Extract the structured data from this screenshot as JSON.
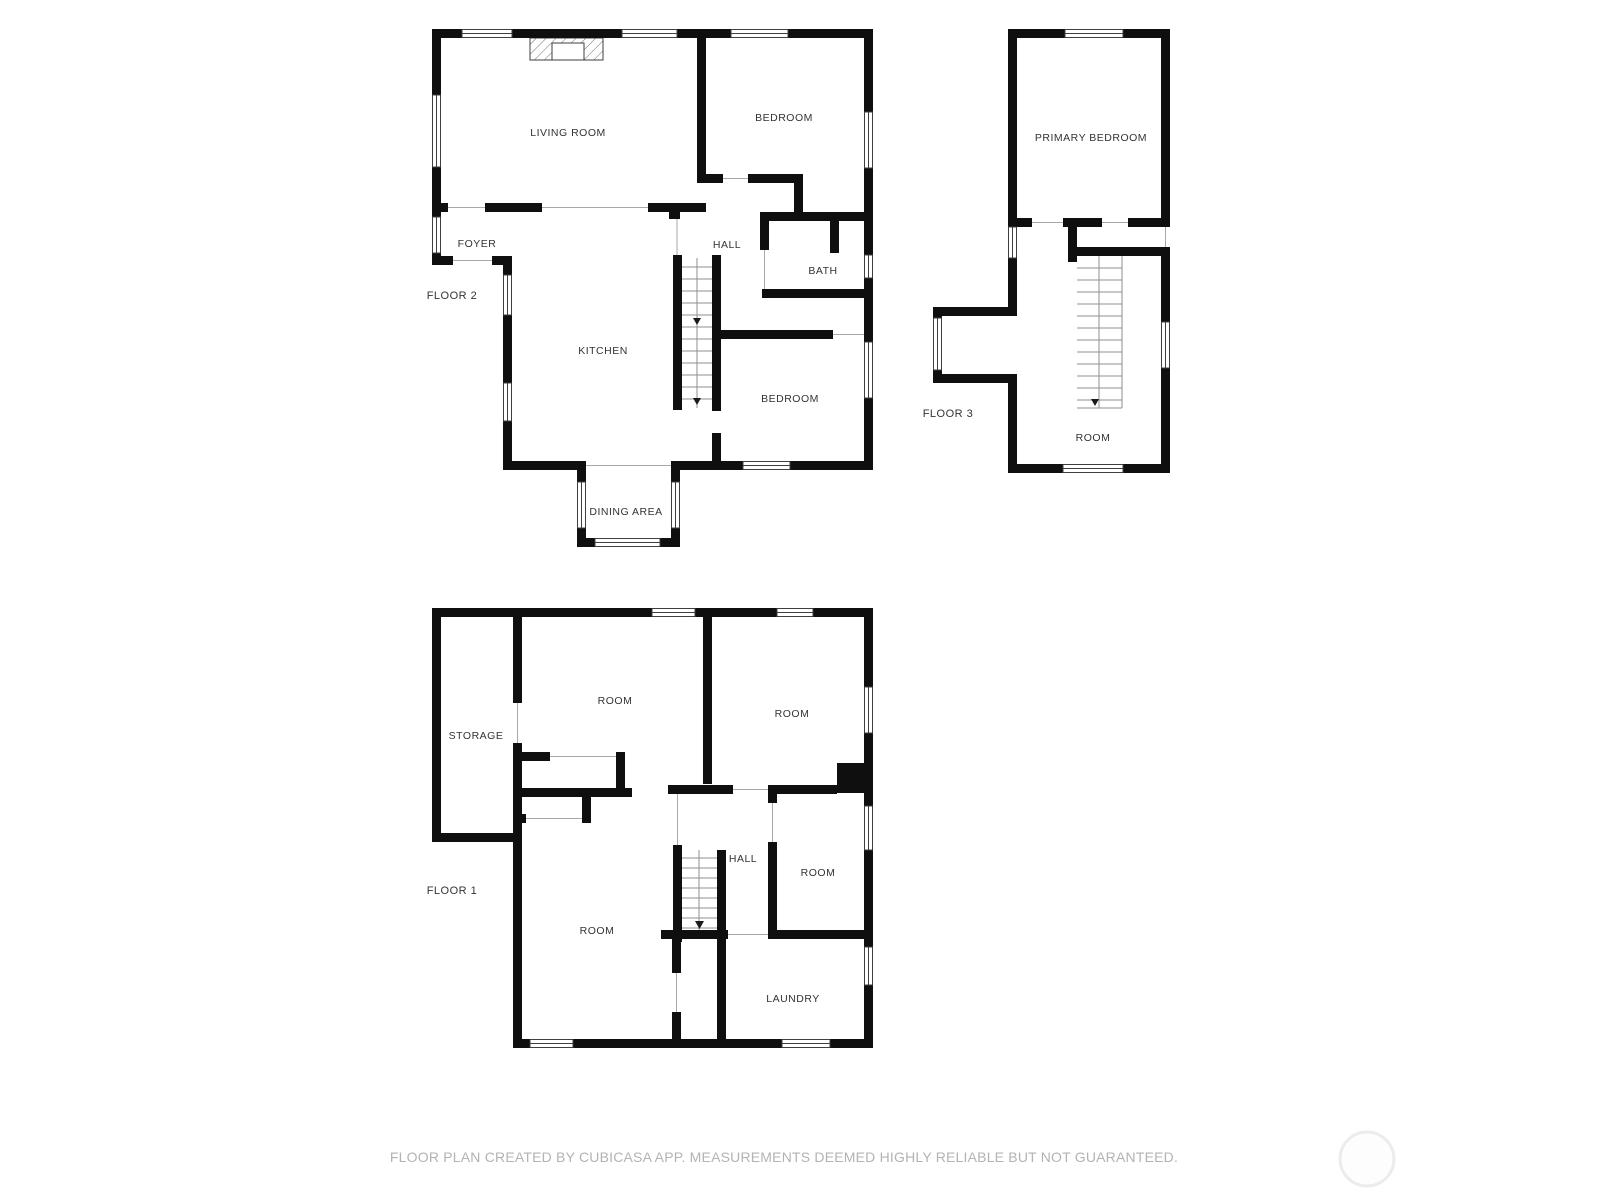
{
  "floor2": {
    "label": "FLOOR 2",
    "rooms": {
      "living": "LIVING ROOM",
      "bedroom_top": "BEDROOM",
      "foyer": "FOYER",
      "hall": "HALL",
      "bath": "BATH",
      "kitchen": "KITCHEN",
      "bedroom_bottom": "BEDROOM",
      "dining": "DINING AREA"
    }
  },
  "floor3": {
    "label": "FLOOR 3",
    "rooms": {
      "primary": "PRIMARY BEDROOM",
      "room": "ROOM"
    }
  },
  "floor1": {
    "label": "FLOOR 1",
    "rooms": {
      "storage": "STORAGE",
      "room_top": "ROOM",
      "room_top_right": "ROOM",
      "hall": "HALL",
      "room_right": "ROOM",
      "room_bottom": "ROOM",
      "laundry": "LAUNDRY"
    }
  },
  "footer": {
    "disclaimer": "FLOOR PLAN CREATED BY CUBICASA APP. MEASUREMENTS DEEMED HIGHLY RELIABLE BUT NOT GUARANTEED."
  },
  "colors": {
    "wall": "#0f0f0f",
    "room_label": "#333333",
    "footer_text": "#b3b3b3",
    "watermark_ring": "#ececec",
    "background": "#ffffff"
  }
}
